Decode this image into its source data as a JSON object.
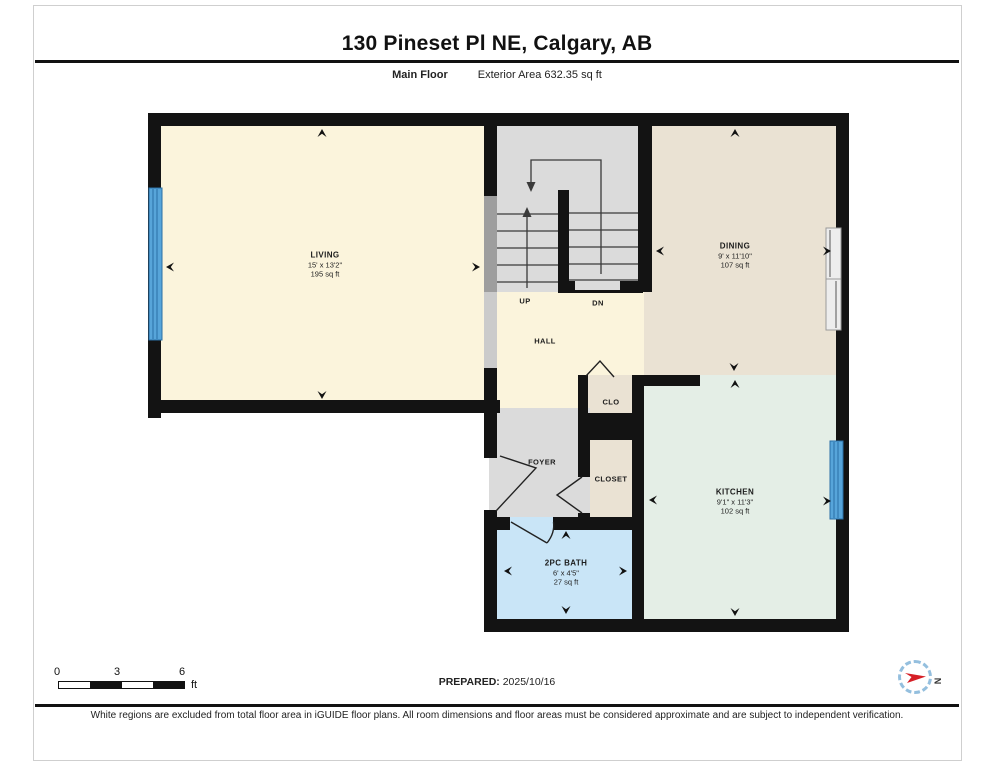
{
  "header": {
    "title": "130 Pineset Pl NE, Calgary, AB",
    "floor_label": "Main Floor",
    "area_label": "Exterior Area 632.35 sq ft"
  },
  "rooms": {
    "living": {
      "name": "LIVING",
      "dims": "15' x 13'2\"",
      "area": "195 sq ft"
    },
    "dining": {
      "name": "DINING",
      "dims": "9' x 11'10\"",
      "area": "107 sq ft"
    },
    "kitchen": {
      "name": "KITCHEN",
      "dims": "9'1\" x 11'3\"",
      "area": "102 sq ft"
    },
    "bath": {
      "name": "2PC BATH",
      "dims": "6' x 4'5\"",
      "area": "27 sq ft"
    },
    "hall": {
      "name": "HALL"
    },
    "foyer": {
      "name": "FOYER"
    },
    "clo": {
      "name": "CLO"
    },
    "closet": {
      "name": "CLOSET"
    },
    "stairs": {
      "up_label": "UP",
      "down_label": "DN"
    }
  },
  "scale_bar": {
    "tick_0": "0",
    "tick_3": "3",
    "tick_6": "6",
    "unit": "ft"
  },
  "compass": {
    "north_label": "N"
  },
  "footer": {
    "prepared_label": "PREPARED:",
    "prepared_date": "2025/10/16",
    "disclaimer": "White regions are excluded from total floor area in iGUIDE floor plans. All room dimensions and floor areas must be considered approximate and are subject to independent verification."
  },
  "colors": {
    "wall": "#131313",
    "room_cream": "#FBF4DC",
    "room_beige": "#EAE2D3",
    "room_mint": "#E4EEE6",
    "room_blue": "#C9E5F7",
    "room_gray": "#DBDBDB",
    "window_blue": "#57A5DA",
    "window_blue_dark": "#2A6FA6",
    "needle_red": "#D61F26",
    "compass_ring": "#94BFDE"
  }
}
